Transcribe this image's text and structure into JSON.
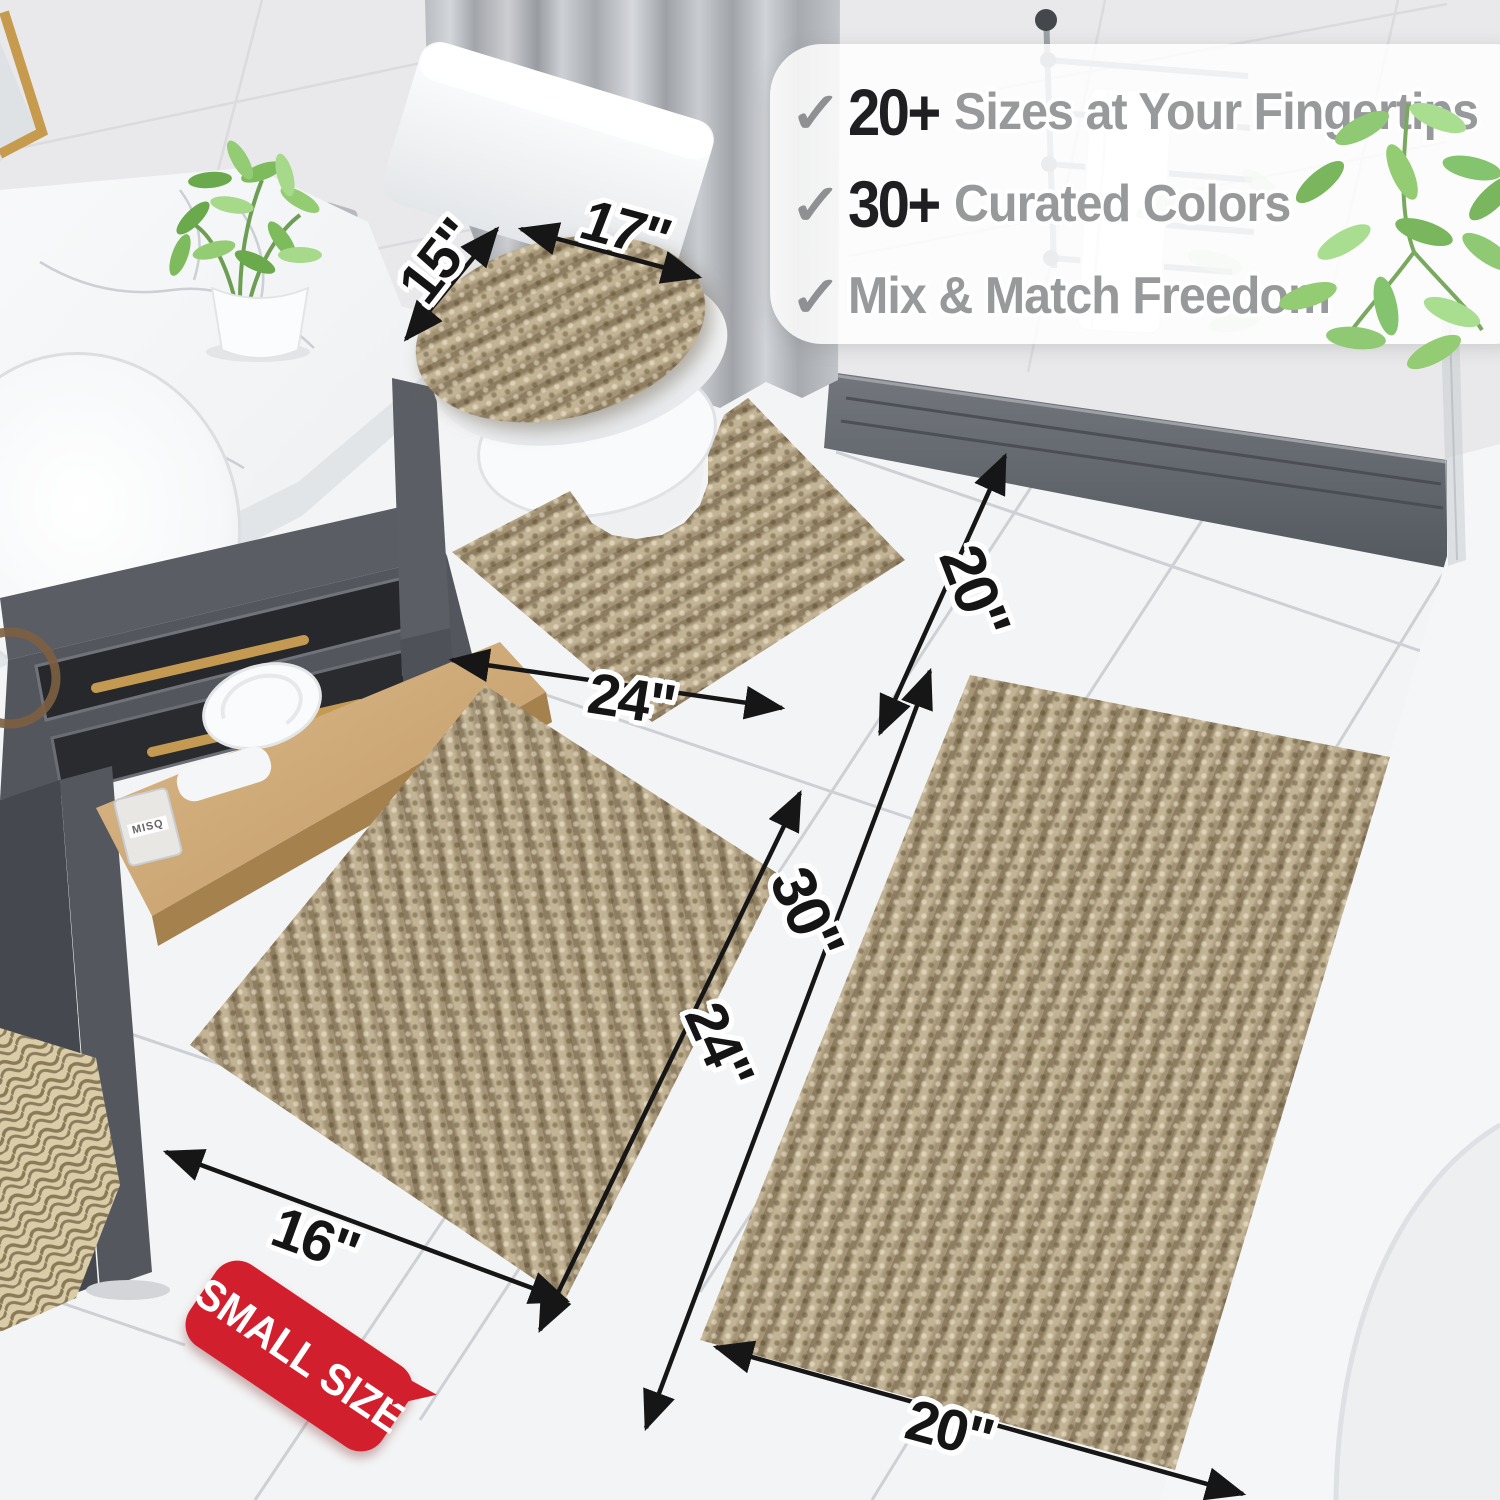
{
  "scene": {
    "setting": "bathroom",
    "product": "striped chenille bath rug set",
    "rug_color": "#b2a183"
  },
  "callout": {
    "items": [
      {
        "check": "✓",
        "stat": "20+",
        "label": "Sizes at Your Fingertips"
      },
      {
        "check": "✓",
        "stat": "30+",
        "label": "Curated Colors"
      },
      {
        "check": "✓",
        "stat": "",
        "label": "Mix & Match Freedom"
      }
    ]
  },
  "dimensions": {
    "lid_depth": "15\"",
    "lid_width": "17\"",
    "contour_width": "24\"",
    "contour_depth": "20\"",
    "small_width": "16\"",
    "small_length": "24\"",
    "large_length": "30\"",
    "large_width": "20\""
  },
  "badge": {
    "text": "SMALL SIZE"
  },
  "props": {
    "perfume_label": "MISQ"
  },
  "colors": {
    "badge_red": "#d21f2e",
    "stat_text": "#1f1f22",
    "feature_text": "#97999b",
    "check_gray": "#8e9092",
    "dimension_text": "#151515",
    "gold_accent": "#c49a52",
    "curtain_gray": "#b3b6bb",
    "vanity_gray": "#54585e",
    "wood_shelf": "#cfa76f",
    "wall_tile": "#e9e9eb",
    "floor_tile": "#f3f4f5"
  }
}
